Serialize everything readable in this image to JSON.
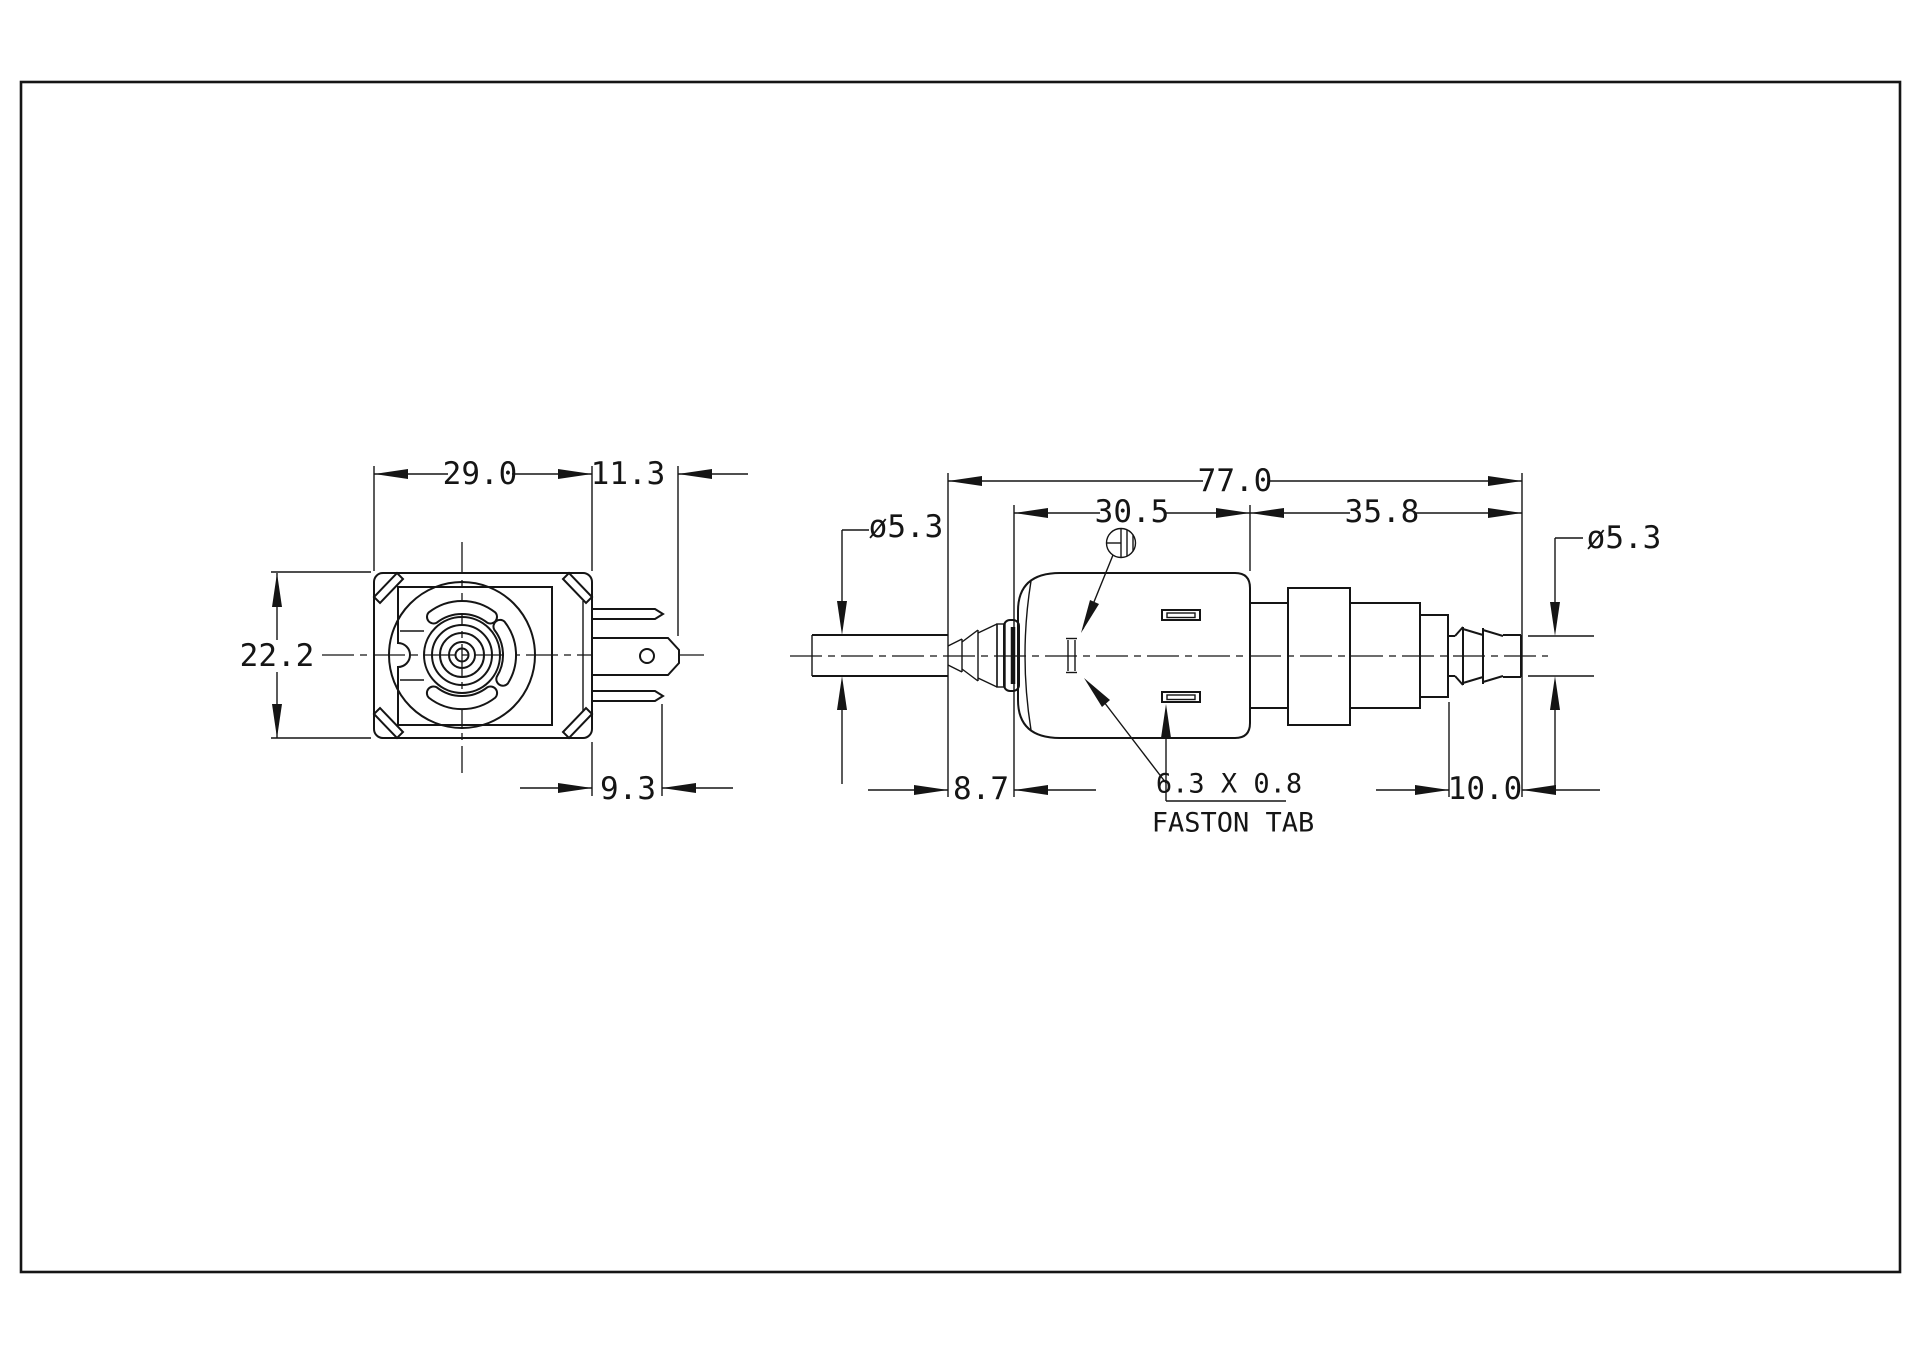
{
  "drawing": {
    "type": "engineering-dimension-drawing",
    "subject": "solenoid vibration pump, two orthographic views",
    "units": "mm"
  },
  "front_view": {
    "body_width": "29.0",
    "connector_projection": "11.3",
    "body_height": "22.2",
    "terminal_length": "9.3"
  },
  "side_view": {
    "overall_length": "77.0",
    "coil_body_length": "30.5",
    "pump_head_length": "35.8",
    "inlet_tube_diameter": "ø5.3",
    "outlet_tube_diameter": "ø5.3",
    "inlet_tube_stickout": "8.7",
    "outlet_barb_length": "10.0",
    "terminal_size": "6.3 X 0.8",
    "terminal_note": "FASTON TAB"
  }
}
